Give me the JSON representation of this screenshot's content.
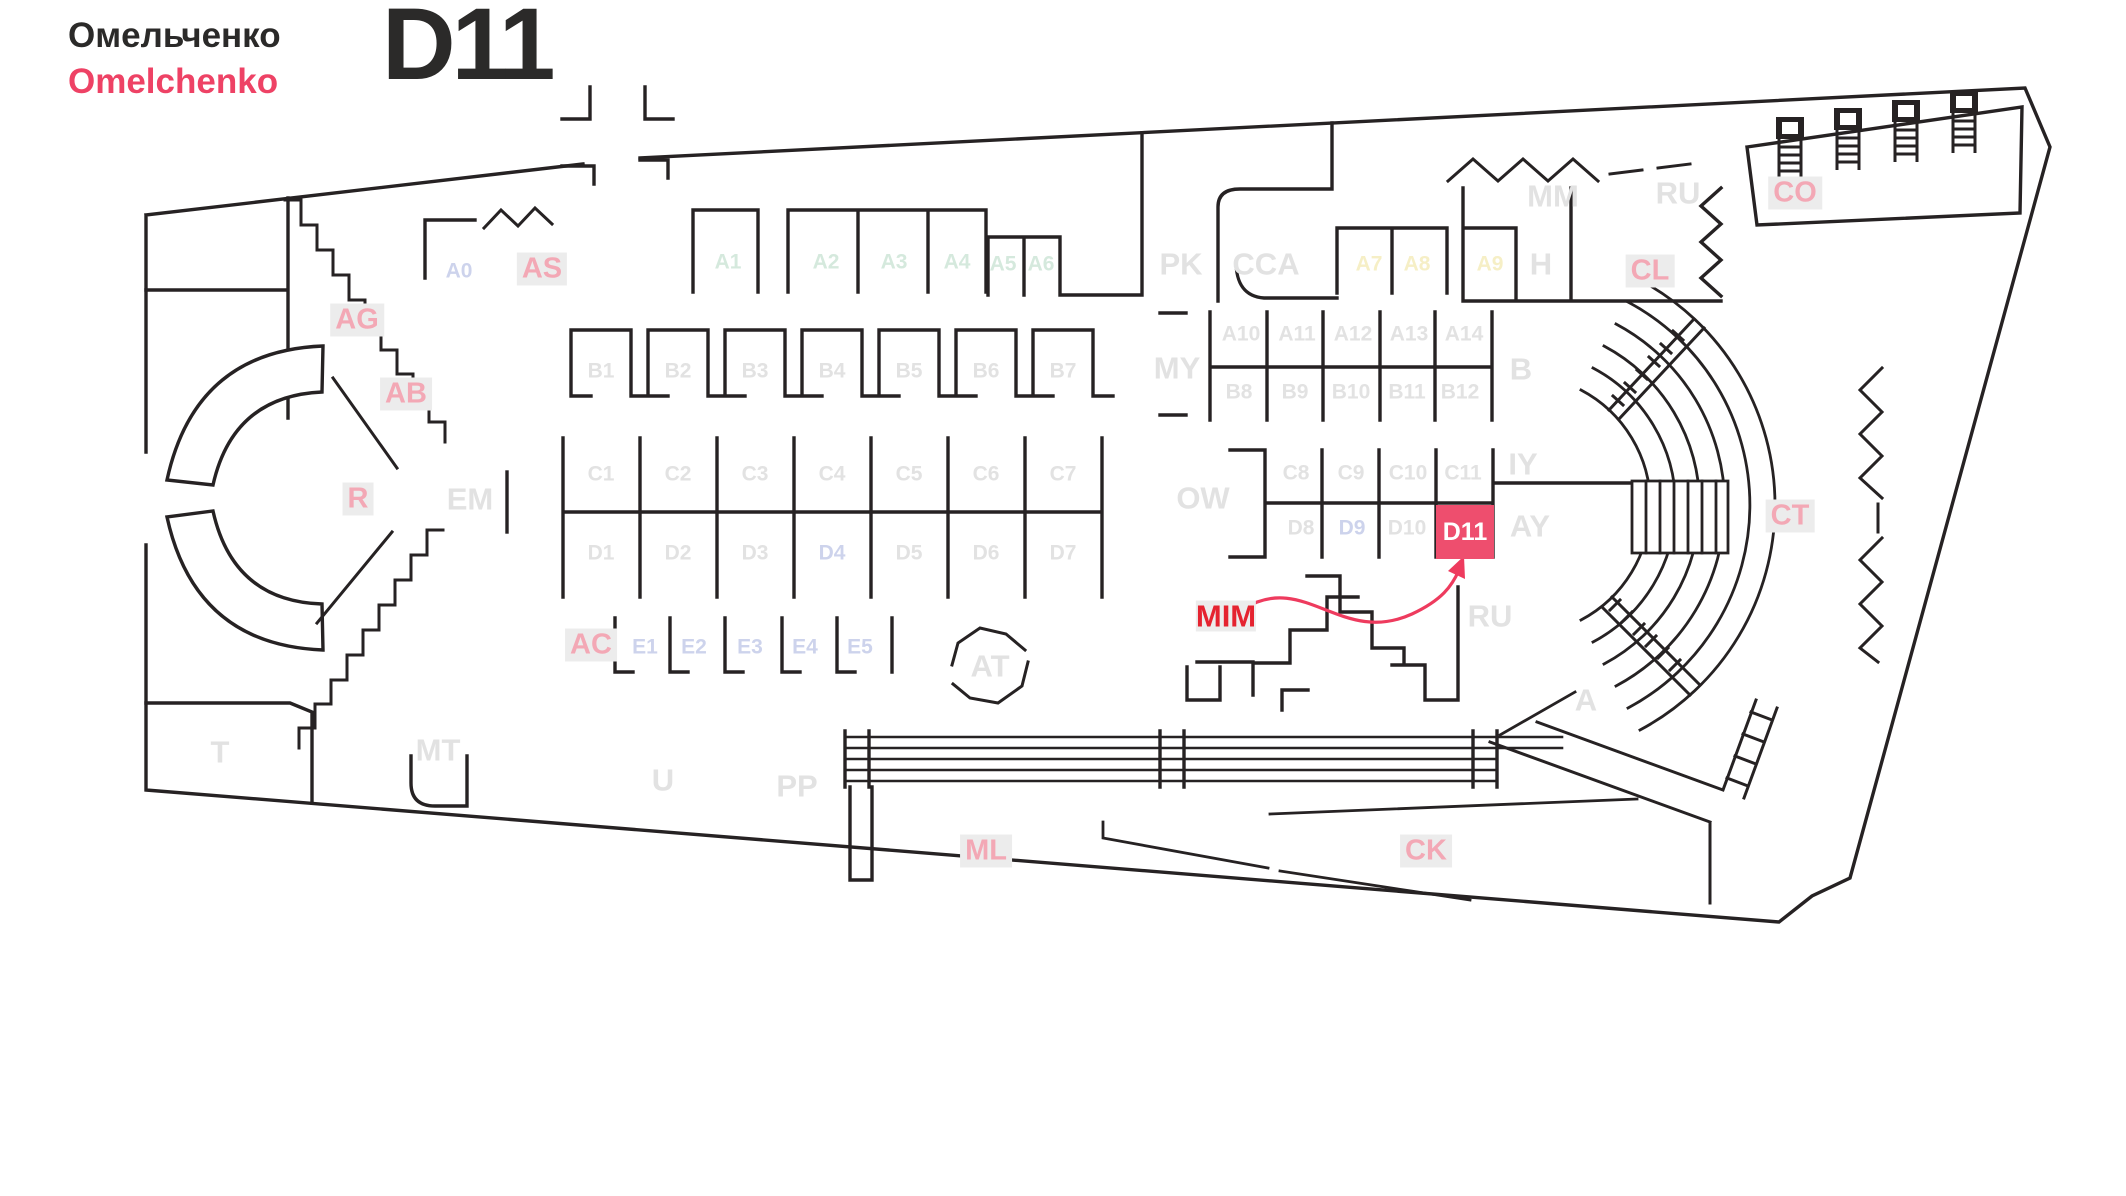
{
  "brand": {
    "name_ru": "Омельченко",
    "name_en": "Omelchenko"
  },
  "header": {
    "booth_code": "D11"
  },
  "highlight": {
    "booth_id": "D11",
    "annotation": "MIM",
    "box_w": 58,
    "box_h": 54,
    "box_x": 1436,
    "box_y": 505
  },
  "colors": {
    "ink": "#262223",
    "accent_red": "#ee4265",
    "arrow_red": "#ee3b5e",
    "label_gray": "#e2e2e2",
    "label_mint": "#d5e9dd",
    "label_lavender": "#cdd3ec",
    "label_yellow": "#f6efc6",
    "label_pink": "#f3a8b5",
    "label_bg": "#ececec",
    "mim_red": "#e52330",
    "d11_box": "#ee4e6e",
    "d11_text": "#ffffff"
  },
  "plan": {
    "labels": [
      {
        "id": "a0",
        "text": "A0",
        "x": 459,
        "y": 271,
        "style": "lav",
        "size": "sm"
      },
      {
        "id": "as",
        "text": "AS",
        "x": 542,
        "y": 269,
        "style": "pink",
        "size": "md"
      },
      {
        "id": "a1",
        "text": "A1",
        "x": 728,
        "y": 262,
        "style": "mint",
        "size": "sm"
      },
      {
        "id": "a2",
        "text": "A2",
        "x": 826,
        "y": 262,
        "style": "mint",
        "size": "sm"
      },
      {
        "id": "a3",
        "text": "A3",
        "x": 894,
        "y": 262,
        "style": "mint",
        "size": "sm"
      },
      {
        "id": "a4",
        "text": "A4",
        "x": 957,
        "y": 262,
        "style": "mint",
        "size": "sm"
      },
      {
        "id": "a5",
        "text": "A5",
        "x": 1003,
        "y": 264,
        "style": "mint",
        "size": "sm"
      },
      {
        "id": "a6",
        "text": "A6",
        "x": 1041,
        "y": 264,
        "style": "mint",
        "size": "sm"
      },
      {
        "id": "pk",
        "text": "PK",
        "x": 1181,
        "y": 264,
        "style": "grayL",
        "size": "lg"
      },
      {
        "id": "cca",
        "text": "CCA",
        "x": 1266,
        "y": 264,
        "style": "grayL",
        "size": "lg"
      },
      {
        "id": "a7",
        "text": "A7",
        "x": 1369,
        "y": 264,
        "style": "yel",
        "size": "sm"
      },
      {
        "id": "a8",
        "text": "A8",
        "x": 1417,
        "y": 264,
        "style": "yel",
        "size": "sm"
      },
      {
        "id": "a9",
        "text": "A9",
        "x": 1490,
        "y": 264,
        "style": "yel",
        "size": "sm"
      },
      {
        "id": "h",
        "text": "H",
        "x": 1541,
        "y": 264,
        "style": "grayL",
        "size": "lg"
      },
      {
        "id": "mm",
        "text": "MM",
        "x": 1553,
        "y": 196,
        "style": "grayL",
        "size": "lg"
      },
      {
        "id": "ru-top",
        "text": "RU",
        "x": 1678,
        "y": 193,
        "style": "grayL",
        "size": "lg"
      },
      {
        "id": "co",
        "text": "CO",
        "x": 1795,
        "y": 193,
        "style": "pink",
        "size": "md"
      },
      {
        "id": "cl",
        "text": "CL",
        "x": 1650,
        "y": 271,
        "style": "pink",
        "size": "md"
      },
      {
        "id": "ag",
        "text": "AG",
        "x": 357,
        "y": 320,
        "style": "pink",
        "size": "md"
      },
      {
        "id": "ab",
        "text": "AB",
        "x": 406,
        "y": 394,
        "style": "pink",
        "size": "md"
      },
      {
        "id": "b1",
        "text": "B1",
        "x": 601,
        "y": 371,
        "style": "gray",
        "size": "sm"
      },
      {
        "id": "b2",
        "text": "B2",
        "x": 678,
        "y": 371,
        "style": "gray",
        "size": "sm"
      },
      {
        "id": "b3",
        "text": "B3",
        "x": 755,
        "y": 371,
        "style": "gray",
        "size": "sm"
      },
      {
        "id": "b4",
        "text": "B4",
        "x": 832,
        "y": 371,
        "style": "gray",
        "size": "sm"
      },
      {
        "id": "b5",
        "text": "B5",
        "x": 909,
        "y": 371,
        "style": "gray",
        "size": "sm"
      },
      {
        "id": "b6",
        "text": "B6",
        "x": 986,
        "y": 371,
        "style": "gray",
        "size": "sm"
      },
      {
        "id": "b7",
        "text": "B7",
        "x": 1063,
        "y": 371,
        "style": "gray",
        "size": "sm"
      },
      {
        "id": "my",
        "text": "MY",
        "x": 1177,
        "y": 368,
        "style": "grayL",
        "size": "lg"
      },
      {
        "id": "a10",
        "text": "A10",
        "x": 1241,
        "y": 334,
        "style": "gray",
        "size": "sm"
      },
      {
        "id": "a11",
        "text": "A11",
        "x": 1297,
        "y": 334,
        "style": "gray",
        "size": "sm"
      },
      {
        "id": "a12",
        "text": "A12",
        "x": 1353,
        "y": 334,
        "style": "gray",
        "size": "sm"
      },
      {
        "id": "a13",
        "text": "A13",
        "x": 1409,
        "y": 334,
        "style": "gray",
        "size": "sm"
      },
      {
        "id": "a14",
        "text": "A14",
        "x": 1464,
        "y": 334,
        "style": "gray",
        "size": "sm"
      },
      {
        "id": "b8",
        "text": "B8",
        "x": 1239,
        "y": 392,
        "style": "gray",
        "size": "sm"
      },
      {
        "id": "b9",
        "text": "B9",
        "x": 1295,
        "y": 392,
        "style": "gray",
        "size": "sm"
      },
      {
        "id": "b10",
        "text": "B10",
        "x": 1351,
        "y": 392,
        "style": "gray",
        "size": "sm"
      },
      {
        "id": "b11",
        "text": "B11",
        "x": 1407,
        "y": 392,
        "style": "gray",
        "size": "sm"
      },
      {
        "id": "b12",
        "text": "B12",
        "x": 1460,
        "y": 392,
        "style": "gray",
        "size": "sm"
      },
      {
        "id": "b-zone",
        "text": "B",
        "x": 1521,
        "y": 369,
        "style": "grayL",
        "size": "lg"
      },
      {
        "id": "r",
        "text": "R",
        "x": 358,
        "y": 499,
        "style": "pink",
        "size": "md"
      },
      {
        "id": "em",
        "text": "EM",
        "x": 470,
        "y": 499,
        "style": "grayL",
        "size": "lg"
      },
      {
        "id": "c1",
        "text": "C1",
        "x": 601,
        "y": 474,
        "style": "gray",
        "size": "sm"
      },
      {
        "id": "c2",
        "text": "C2",
        "x": 678,
        "y": 474,
        "style": "gray",
        "size": "sm"
      },
      {
        "id": "c3",
        "text": "C3",
        "x": 755,
        "y": 474,
        "style": "gray",
        "size": "sm"
      },
      {
        "id": "c4",
        "text": "C4",
        "x": 832,
        "y": 474,
        "style": "gray",
        "size": "sm"
      },
      {
        "id": "c5",
        "text": "C5",
        "x": 909,
        "y": 474,
        "style": "gray",
        "size": "sm"
      },
      {
        "id": "c6",
        "text": "C6",
        "x": 986,
        "y": 474,
        "style": "gray",
        "size": "sm"
      },
      {
        "id": "c7",
        "text": "C7",
        "x": 1063,
        "y": 474,
        "style": "gray",
        "size": "sm"
      },
      {
        "id": "ow",
        "text": "OW",
        "x": 1203,
        "y": 498,
        "style": "grayL",
        "size": "lg"
      },
      {
        "id": "c8",
        "text": "C8",
        "x": 1296,
        "y": 473,
        "style": "gray",
        "size": "sm"
      },
      {
        "id": "c9",
        "text": "C9",
        "x": 1351,
        "y": 473,
        "style": "gray",
        "size": "sm"
      },
      {
        "id": "c10",
        "text": "C10",
        "x": 1408,
        "y": 473,
        "style": "gray",
        "size": "sm"
      },
      {
        "id": "c11",
        "text": "C11",
        "x": 1463,
        "y": 473,
        "style": "gray",
        "size": "sm"
      },
      {
        "id": "iy",
        "text": "IY",
        "x": 1523,
        "y": 464,
        "style": "grayL",
        "size": "lg"
      },
      {
        "id": "d1",
        "text": "D1",
        "x": 601,
        "y": 553,
        "style": "gray",
        "size": "sm"
      },
      {
        "id": "d2",
        "text": "D2",
        "x": 678,
        "y": 553,
        "style": "gray",
        "size": "sm"
      },
      {
        "id": "d3",
        "text": "D3",
        "x": 755,
        "y": 553,
        "style": "gray",
        "size": "sm"
      },
      {
        "id": "d4",
        "text": "D4",
        "x": 832,
        "y": 553,
        "style": "lav",
        "size": "sm"
      },
      {
        "id": "d5",
        "text": "D5",
        "x": 909,
        "y": 553,
        "style": "gray",
        "size": "sm"
      },
      {
        "id": "d6",
        "text": "D6",
        "x": 986,
        "y": 553,
        "style": "gray",
        "size": "sm"
      },
      {
        "id": "d7",
        "text": "D7",
        "x": 1063,
        "y": 553,
        "style": "gray",
        "size": "sm"
      },
      {
        "id": "d8",
        "text": "D8",
        "x": 1301,
        "y": 528,
        "style": "gray",
        "size": "sm"
      },
      {
        "id": "d9",
        "text": "D9",
        "x": 1352,
        "y": 528,
        "style": "lav",
        "size": "sm"
      },
      {
        "id": "d10",
        "text": "D10",
        "x": 1407,
        "y": 528,
        "style": "gray",
        "size": "sm"
      },
      {
        "id": "d11",
        "text": "D11",
        "x": 1465,
        "y": 532,
        "style": "hl",
        "size": "hl"
      },
      {
        "id": "ay",
        "text": "AY",
        "x": 1530,
        "y": 526,
        "style": "grayL",
        "size": "lg"
      },
      {
        "id": "ac",
        "text": "AC",
        "x": 591,
        "y": 645,
        "style": "pink",
        "size": "md"
      },
      {
        "id": "e1",
        "text": "E1",
        "x": 645,
        "y": 647,
        "style": "lav",
        "size": "sm"
      },
      {
        "id": "e2",
        "text": "E2",
        "x": 694,
        "y": 647,
        "style": "lav",
        "size": "sm"
      },
      {
        "id": "e3",
        "text": "E3",
        "x": 750,
        "y": 647,
        "style": "lav",
        "size": "sm"
      },
      {
        "id": "e4",
        "text": "E4",
        "x": 805,
        "y": 647,
        "style": "lav",
        "size": "sm"
      },
      {
        "id": "e5",
        "text": "E5",
        "x": 860,
        "y": 647,
        "style": "lav",
        "size": "sm"
      },
      {
        "id": "at",
        "text": "AT",
        "x": 990,
        "y": 666,
        "style": "grayL",
        "size": "lg"
      },
      {
        "id": "mim",
        "text": "MIM",
        "x": 1226,
        "y": 616,
        "style": "red",
        "size": "lg"
      },
      {
        "id": "ru-mid",
        "text": "RU",
        "x": 1490,
        "y": 616,
        "style": "grayL",
        "size": "lg"
      },
      {
        "id": "a-zone",
        "text": "A",
        "x": 1586,
        "y": 700,
        "style": "grayL",
        "size": "lg"
      },
      {
        "id": "ct",
        "text": "CT",
        "x": 1790,
        "y": 516,
        "style": "pink",
        "size": "md"
      },
      {
        "id": "t",
        "text": "T",
        "x": 220,
        "y": 752,
        "style": "grayL",
        "size": "lg"
      },
      {
        "id": "mt",
        "text": "MT",
        "x": 438,
        "y": 750,
        "style": "grayL",
        "size": "lg"
      },
      {
        "id": "u",
        "text": "U",
        "x": 663,
        "y": 780,
        "style": "grayL",
        "size": "lg"
      },
      {
        "id": "pp",
        "text": "PP",
        "x": 797,
        "y": 786,
        "style": "grayL",
        "size": "lg"
      },
      {
        "id": "ml",
        "text": "ML",
        "x": 986,
        "y": 851,
        "style": "pink",
        "size": "md"
      },
      {
        "id": "ck",
        "text": "CK",
        "x": 1426,
        "y": 851,
        "style": "pink",
        "size": "md"
      }
    ]
  }
}
